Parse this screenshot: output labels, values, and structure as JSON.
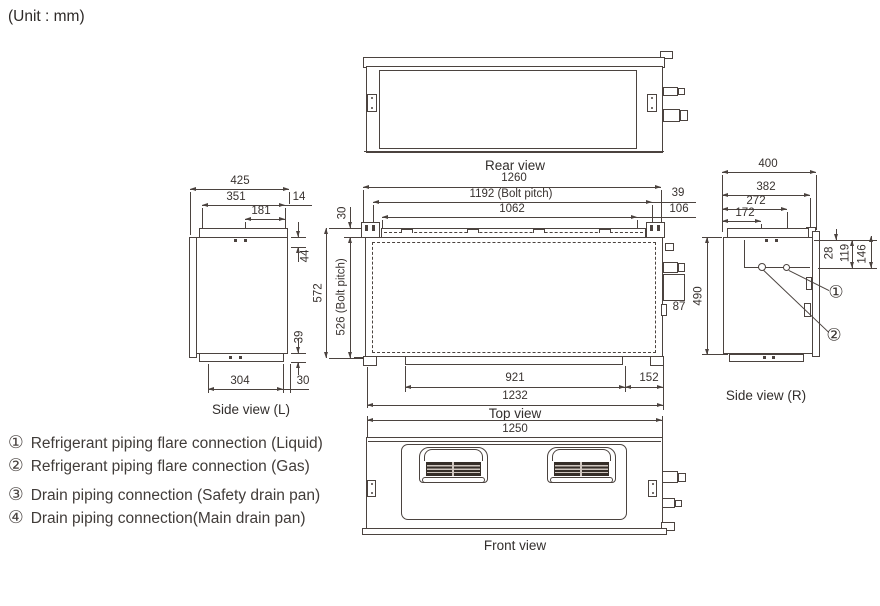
{
  "unit_label": "(Unit : mm)",
  "views": {
    "rear": {
      "label": "Rear view"
    },
    "top": {
      "label": "Top view",
      "dims": {
        "total_width": "1260",
        "bolt_pitch_width": "1192 (Bolt pitch)",
        "inner_width": "1062",
        "right_39": "39",
        "right_106": "106",
        "flange_30": "30",
        "depth": "572",
        "bolt_pitch_depth": "526 (Bolt pitch)",
        "pipe_87": "87",
        "bottom_921": "921",
        "bottom_152": "152",
        "bottom_total": "1232"
      }
    },
    "front": {
      "label": "Front view",
      "dims": {
        "width": "1250"
      }
    },
    "side_l": {
      "label": "Side view (L)",
      "dims": {
        "total_depth": "425",
        "top_351": "351",
        "top_181": "181",
        "top_14": "14",
        "right_44": "44",
        "right_39": "39",
        "bottom_304": "304",
        "bottom_30": "30"
      }
    },
    "side_r": {
      "label": "Side view (R)",
      "dims": {
        "total_depth": "400",
        "d_382": "382",
        "d_272": "272",
        "d_172": "172",
        "v_28": "28",
        "v_119": "119",
        "v_146": "146",
        "height": "490"
      },
      "callouts": {
        "c1": "①",
        "c2": "②"
      }
    }
  },
  "legend": {
    "items": [
      {
        "symbol": "①",
        "text": "Refrigerant piping flare connection (Liquid)"
      },
      {
        "symbol": "②",
        "text": "Refrigerant piping flare connection (Gas)"
      },
      {
        "symbol": "③",
        "text": "Drain piping connection (Safety drain pan)"
      },
      {
        "symbol": "④",
        "text": "Drain piping connection(Main drain pan)"
      }
    ]
  }
}
